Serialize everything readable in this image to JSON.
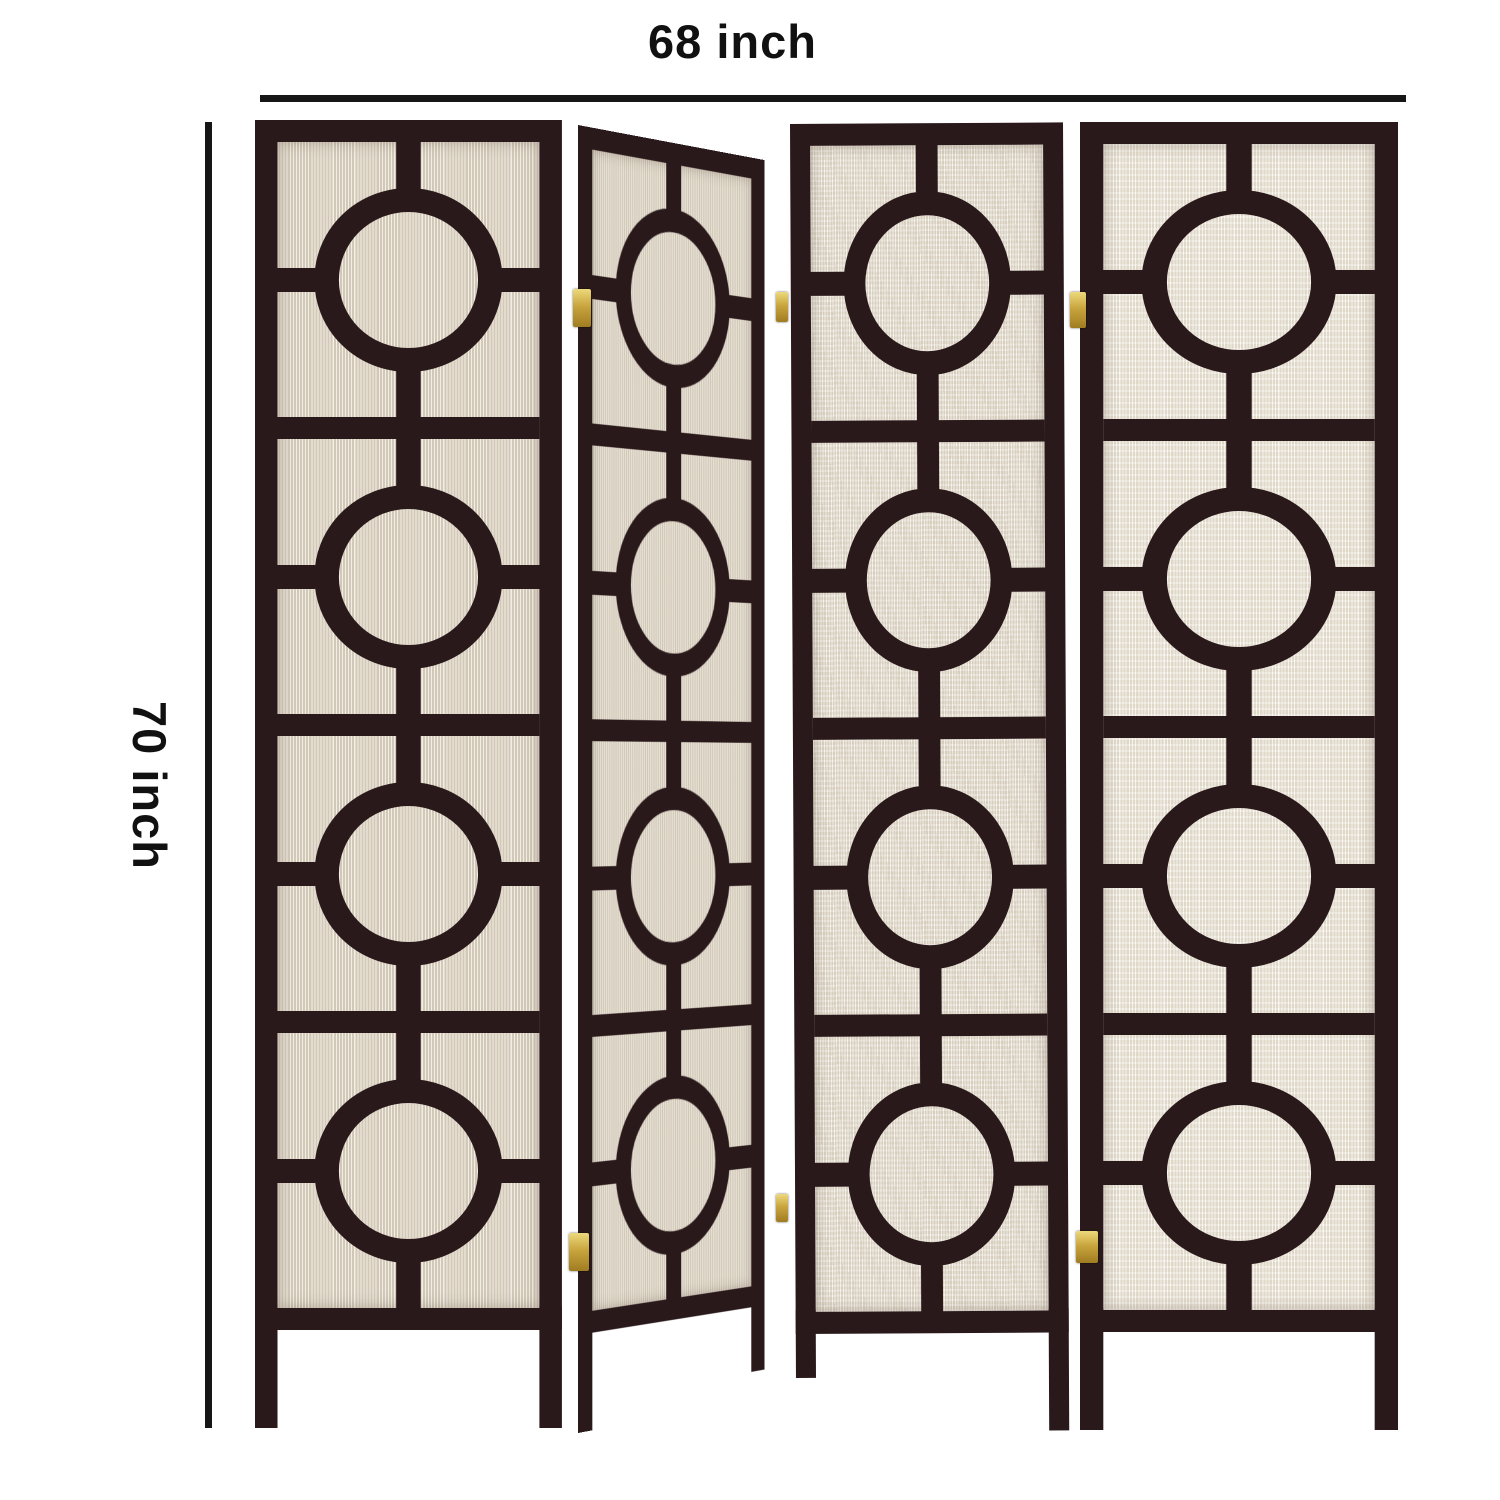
{
  "dimensions": {
    "width_label": "68 inch",
    "height_label": "70 inch"
  },
  "product": {
    "panel_count": 4,
    "circles_per_panel": 4,
    "frame_color": "#2a191b",
    "fabric_color": "#e4dccd",
    "fabric_color_light": "#efe9dd",
    "hinge_color": "#c9a53e",
    "hinge_count": 6,
    "annotation_color": "#161616",
    "panels": [
      {
        "name": "panel-1"
      },
      {
        "name": "panel-2"
      },
      {
        "name": "panel-3"
      },
      {
        "name": "panel-4"
      }
    ]
  }
}
